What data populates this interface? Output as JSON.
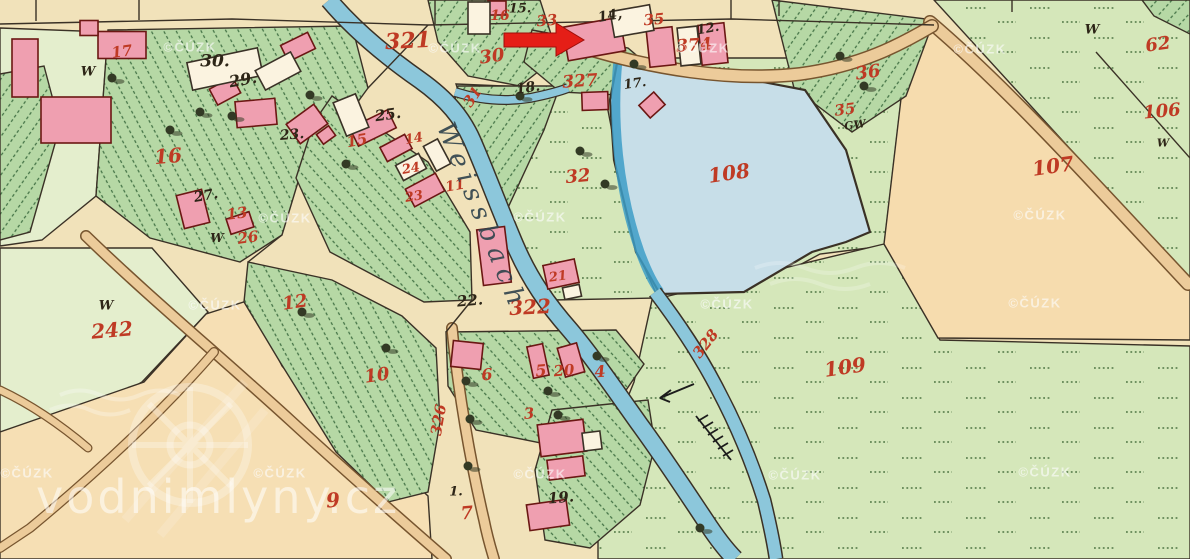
{
  "map": {
    "stream_name": "Weissbach",
    "red_labels": [
      {
        "t": "17",
        "x": 122,
        "y": 52,
        "r": -8,
        "s": 15
      },
      {
        "t": "16",
        "x": 168,
        "y": 156,
        "r": -5,
        "s": 20
      },
      {
        "t": "321",
        "x": 408,
        "y": 41,
        "r": -3,
        "s": 22
      },
      {
        "t": "30",
        "x": 492,
        "y": 57,
        "r": -8,
        "s": 18
      },
      {
        "t": "16",
        "x": 500,
        "y": 16,
        "r": 0,
        "s": 14
      },
      {
        "t": "33",
        "x": 547,
        "y": 21,
        "r": -5,
        "s": 15
      },
      {
        "t": "35",
        "x": 654,
        "y": 20,
        "r": -5,
        "s": 15
      },
      {
        "t": "374",
        "x": 694,
        "y": 46,
        "r": -4,
        "s": 17
      },
      {
        "t": "36",
        "x": 868,
        "y": 73,
        "r": -8,
        "s": 18
      },
      {
        "t": "35",
        "x": 845,
        "y": 110,
        "r": -8,
        "s": 15
      },
      {
        "t": "62",
        "x": 1158,
        "y": 45,
        "r": -8,
        "s": 18
      },
      {
        "t": "106",
        "x": 1162,
        "y": 112,
        "r": -5,
        "s": 18
      },
      {
        "t": "107",
        "x": 1053,
        "y": 166,
        "r": -8,
        "s": 20
      },
      {
        "t": "108",
        "x": 729,
        "y": 173,
        "r": -8,
        "s": 20
      },
      {
        "t": "327",
        "x": 580,
        "y": 82,
        "r": -4,
        "s": 17
      },
      {
        "t": "31",
        "x": 473,
        "y": 97,
        "r": -55,
        "s": 15
      },
      {
        "t": "32",
        "x": 578,
        "y": 177,
        "r": -5,
        "s": 18
      },
      {
        "t": "15",
        "x": 357,
        "y": 141,
        "r": -10,
        "s": 15
      },
      {
        "t": "14",
        "x": 414,
        "y": 139,
        "r": -10,
        "s": 13
      },
      {
        "t": "24",
        "x": 411,
        "y": 169,
        "r": -10,
        "s": 13
      },
      {
        "t": "23",
        "x": 414,
        "y": 197,
        "r": -10,
        "s": 13
      },
      {
        "t": "11",
        "x": 455,
        "y": 186,
        "r": -10,
        "s": 14
      },
      {
        "t": "13",
        "x": 237,
        "y": 214,
        "r": -8,
        "s": 15
      },
      {
        "t": "26",
        "x": 248,
        "y": 238,
        "r": -8,
        "s": 15
      },
      {
        "t": "242",
        "x": 112,
        "y": 330,
        "r": -5,
        "s": 20
      },
      {
        "t": "12",
        "x": 295,
        "y": 303,
        "r": -8,
        "s": 18
      },
      {
        "t": "10",
        "x": 377,
        "y": 376,
        "r": -8,
        "s": 18
      },
      {
        "t": "322",
        "x": 530,
        "y": 307,
        "r": -3,
        "s": 20
      },
      {
        "t": "21",
        "x": 558,
        "y": 277,
        "r": -8,
        "s": 13
      },
      {
        "t": "6",
        "x": 487,
        "y": 375,
        "r": -5,
        "s": 16
      },
      {
        "t": "5",
        "x": 541,
        "y": 371,
        "r": -5,
        "s": 16
      },
      {
        "t": "20",
        "x": 564,
        "y": 371,
        "r": -5,
        "s": 15
      },
      {
        "t": "4",
        "x": 600,
        "y": 372,
        "r": -5,
        "s": 16
      },
      {
        "t": "3",
        "x": 529,
        "y": 414,
        "r": -5,
        "s": 15
      },
      {
        "t": "9",
        "x": 333,
        "y": 500,
        "r": -5,
        "s": 20
      },
      {
        "t": "7",
        "x": 467,
        "y": 514,
        "r": -5,
        "s": 18
      },
      {
        "t": "326",
        "x": 439,
        "y": 420,
        "r": -80,
        "s": 15
      },
      {
        "t": "328",
        "x": 706,
        "y": 344,
        "r": -52,
        "s": 15
      },
      {
        "t": "109",
        "x": 845,
        "y": 367,
        "r": -8,
        "s": 20
      }
    ],
    "black_labels": [
      {
        "t": "30.",
        "x": 215,
        "y": 62,
        "r": 0,
        "s": 17
      },
      {
        "t": "29.",
        "x": 243,
        "y": 80,
        "r": -10,
        "s": 16
      },
      {
        "t": "23.",
        "x": 292,
        "y": 135,
        "r": -5,
        "s": 14
      },
      {
        "t": "25.",
        "x": 388,
        "y": 115,
        "r": -8,
        "s": 15
      },
      {
        "t": "27.",
        "x": 206,
        "y": 196,
        "r": -10,
        "s": 14
      },
      {
        "t": "15.",
        "x": 520,
        "y": 9,
        "r": 0,
        "s": 13
      },
      {
        "t": "14,",
        "x": 610,
        "y": 16,
        "r": -10,
        "s": 14
      },
      {
        "t": "12.",
        "x": 708,
        "y": 29,
        "r": -10,
        "s": 13
      },
      {
        "t": "18.",
        "x": 528,
        "y": 88,
        "r": -8,
        "s": 14
      },
      {
        "t": "17.",
        "x": 635,
        "y": 84,
        "r": -8,
        "s": 13
      },
      {
        "t": "22.",
        "x": 470,
        "y": 301,
        "r": -5,
        "s": 15
      },
      {
        "t": "19.",
        "x": 561,
        "y": 498,
        "r": -5,
        "s": 15
      },
      {
        "t": "1.",
        "x": 456,
        "y": 492,
        "r": 0,
        "s": 13
      },
      {
        "t": "GW",
        "x": 855,
        "y": 125,
        "r": -8,
        "s": 11
      },
      {
        "t": "W",
        "x": 88,
        "y": 72,
        "r": 0,
        "s": 13
      },
      {
        "t": "W",
        "x": 217,
        "y": 238,
        "r": 0,
        "s": 12
      },
      {
        "t": "W",
        "x": 106,
        "y": 306,
        "r": 0,
        "s": 13
      },
      {
        "t": "W",
        "x": 1092,
        "y": 30,
        "r": 0,
        "s": 13
      },
      {
        "t": "W",
        "x": 1163,
        "y": 143,
        "r": 0,
        "s": 11
      }
    ]
  },
  "annotation": {
    "arrow_direction": "right"
  },
  "watermarks": {
    "copyright": "©ČÚZK",
    "positions": [
      [
        190,
        47
      ],
      [
        455,
        48
      ],
      [
        703,
        48
      ],
      [
        980,
        49
      ],
      [
        285,
        218
      ],
      [
        540,
        217
      ],
      [
        1040,
        215
      ],
      [
        215,
        305
      ],
      [
        727,
        304
      ],
      [
        1035,
        303
      ],
      [
        280,
        473
      ],
      [
        540,
        474
      ],
      [
        795,
        475
      ],
      [
        1045,
        472
      ],
      [
        27,
        473
      ]
    ],
    "site": "vodnimlyny.cz"
  },
  "colors": {
    "paper": "#f1e2ba",
    "pale": "#e4eecd",
    "meadow": "#d5e7ba",
    "field": "#b6d8a5",
    "hatchline": "#447346",
    "water": "#8cc7db",
    "waterdark": "#3d9ec7",
    "pond": "#c7dee8",
    "road": "#eccb9a",
    "roadedge": "#77552f",
    "building": "#ef9fb0",
    "buildingline": "#6b1713",
    "whitebldg": "#fbf3e0",
    "line": "#3a3126",
    "label_red": "#bf3a24",
    "label_black": "#2d2517",
    "arrow": "#e51e17",
    "tree": "#333a25"
  }
}
